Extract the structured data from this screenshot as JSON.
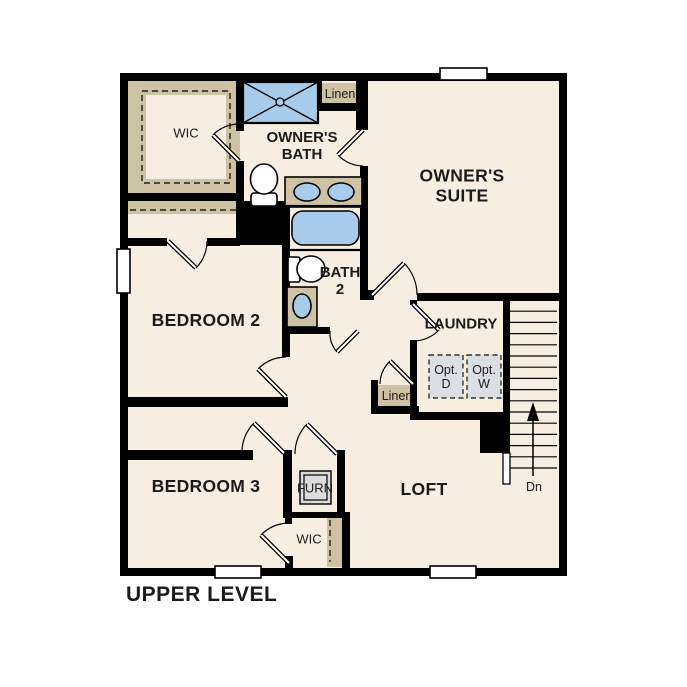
{
  "title": "UPPER LEVEL",
  "rooms": {
    "owners_wic": "WIC",
    "owners_bath": "OWNER'S\nBATH",
    "linen_top": "Linen",
    "owners_suite": "OWNER'S\nSUITE",
    "bedroom2": "BEDROOM 2",
    "bath2": "BATH\n2",
    "laundry": "LAUNDRY",
    "opt_dryer": "Opt.\nD",
    "opt_washer": "Opt.\nW",
    "linen_hall": "Linen",
    "bedroom3": "BEDROOM 3",
    "furnace": "FURN",
    "loft": "LOFT",
    "bedroom3_wic": "WIC",
    "stairs_down": "Dn"
  },
  "colors": {
    "floor": "#f6efe1",
    "wall": "#000000",
    "closet": "#cec2a5",
    "fixture": "#a9cbea",
    "optbox": "#dbdfe3",
    "furn_unit": "#dcdcdc",
    "ink": "#1b1b1b",
    "canvas": "#ffffff"
  }
}
